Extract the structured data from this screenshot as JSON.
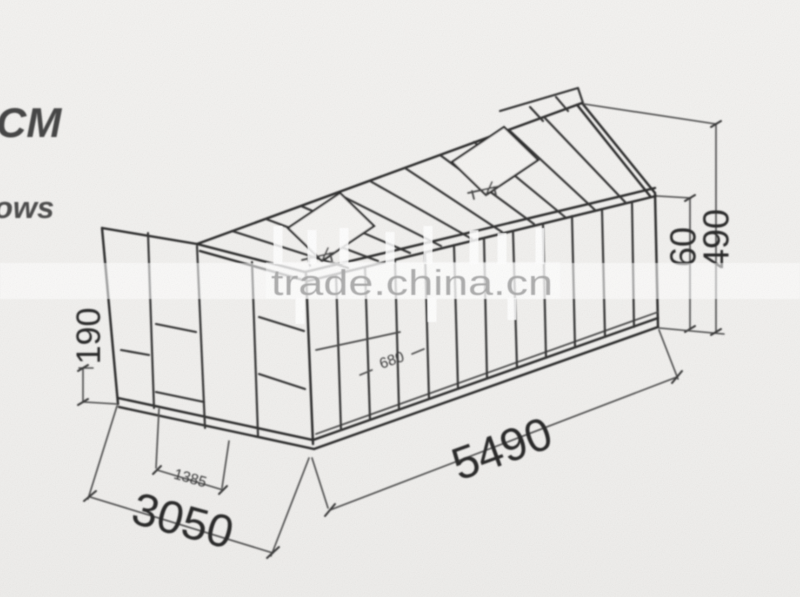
{
  "meta": {
    "background_color": "#f1f0ee",
    "line_color": "#2d2d2d",
    "dimension_text_color": "#292929",
    "watermark_color": "#a7a7a7"
  },
  "corner_texts": {
    "top_partial": "CM",
    "bottom_partial": "ows"
  },
  "watermark": {
    "text": "trade.china.cn"
  },
  "drawing": {
    "dimensions": {
      "length": "5490",
      "width": "3050",
      "door_width": "1385",
      "base_height": "190",
      "bay_width": "680",
      "eave_offset": "60",
      "ridge_height": "490"
    }
  }
}
